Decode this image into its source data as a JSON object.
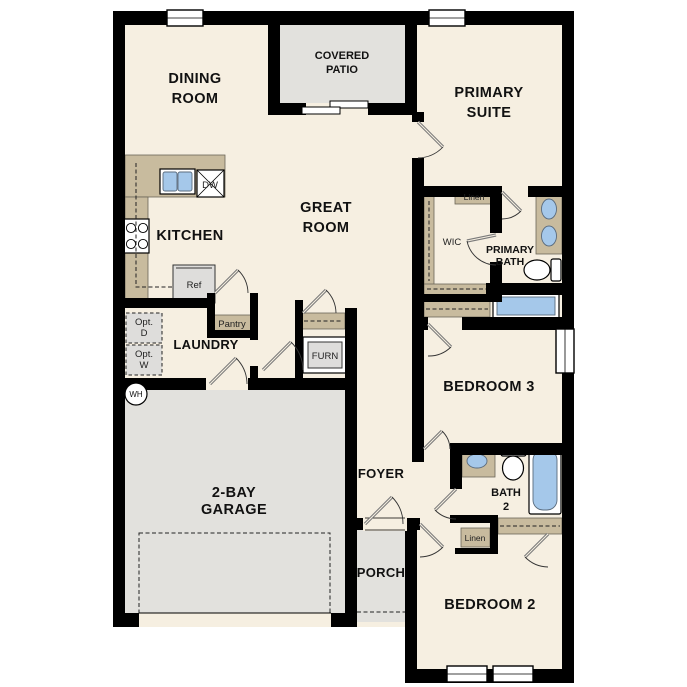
{
  "title": "Single-story home floor plan",
  "colors": {
    "floor": "#f6efe1",
    "wall": "#000000",
    "counter": "#c8bb9e",
    "concrete": "#e2e1dd",
    "fixture": "#a5c8ea",
    "appliance": "#dedddb"
  },
  "rooms": {
    "dining": {
      "line1": "DINING",
      "line2": "ROOM"
    },
    "covered_patio": {
      "line1": "COVERED",
      "line2": "PATIO"
    },
    "primary_suite": {
      "line1": "PRIMARY",
      "line2": "SUITE"
    },
    "great_room": {
      "line1": "GREAT",
      "line2": "ROOM"
    },
    "kitchen": {
      "label": "KITCHEN"
    },
    "laundry": {
      "label": "LAUNDRY"
    },
    "wic": {
      "label": "WIC"
    },
    "primary_bath": {
      "line1": "PRIMARY",
      "line2": "BATH"
    },
    "bedroom3": {
      "label": "BEDROOM 3"
    },
    "foyer": {
      "label": "FOYER"
    },
    "bath2": {
      "line1": "BATH",
      "line2": "2"
    },
    "garage": {
      "line1": "2-BAY",
      "line2": "GARAGE"
    },
    "porch": {
      "label": "PORCH"
    },
    "bedroom2": {
      "label": "BEDROOM 2"
    }
  },
  "features": {
    "pantry": "Pantry",
    "linen_upper": "Linen",
    "linen_lower": "Linen",
    "furnace": "FURN",
    "refrigerator": "Ref",
    "dishwasher": "DW",
    "water_heater": "WH",
    "opt_d_line1": "Opt.",
    "opt_d_line2": "D",
    "opt_w_line1": "Opt.",
    "opt_w_line2": "W"
  }
}
